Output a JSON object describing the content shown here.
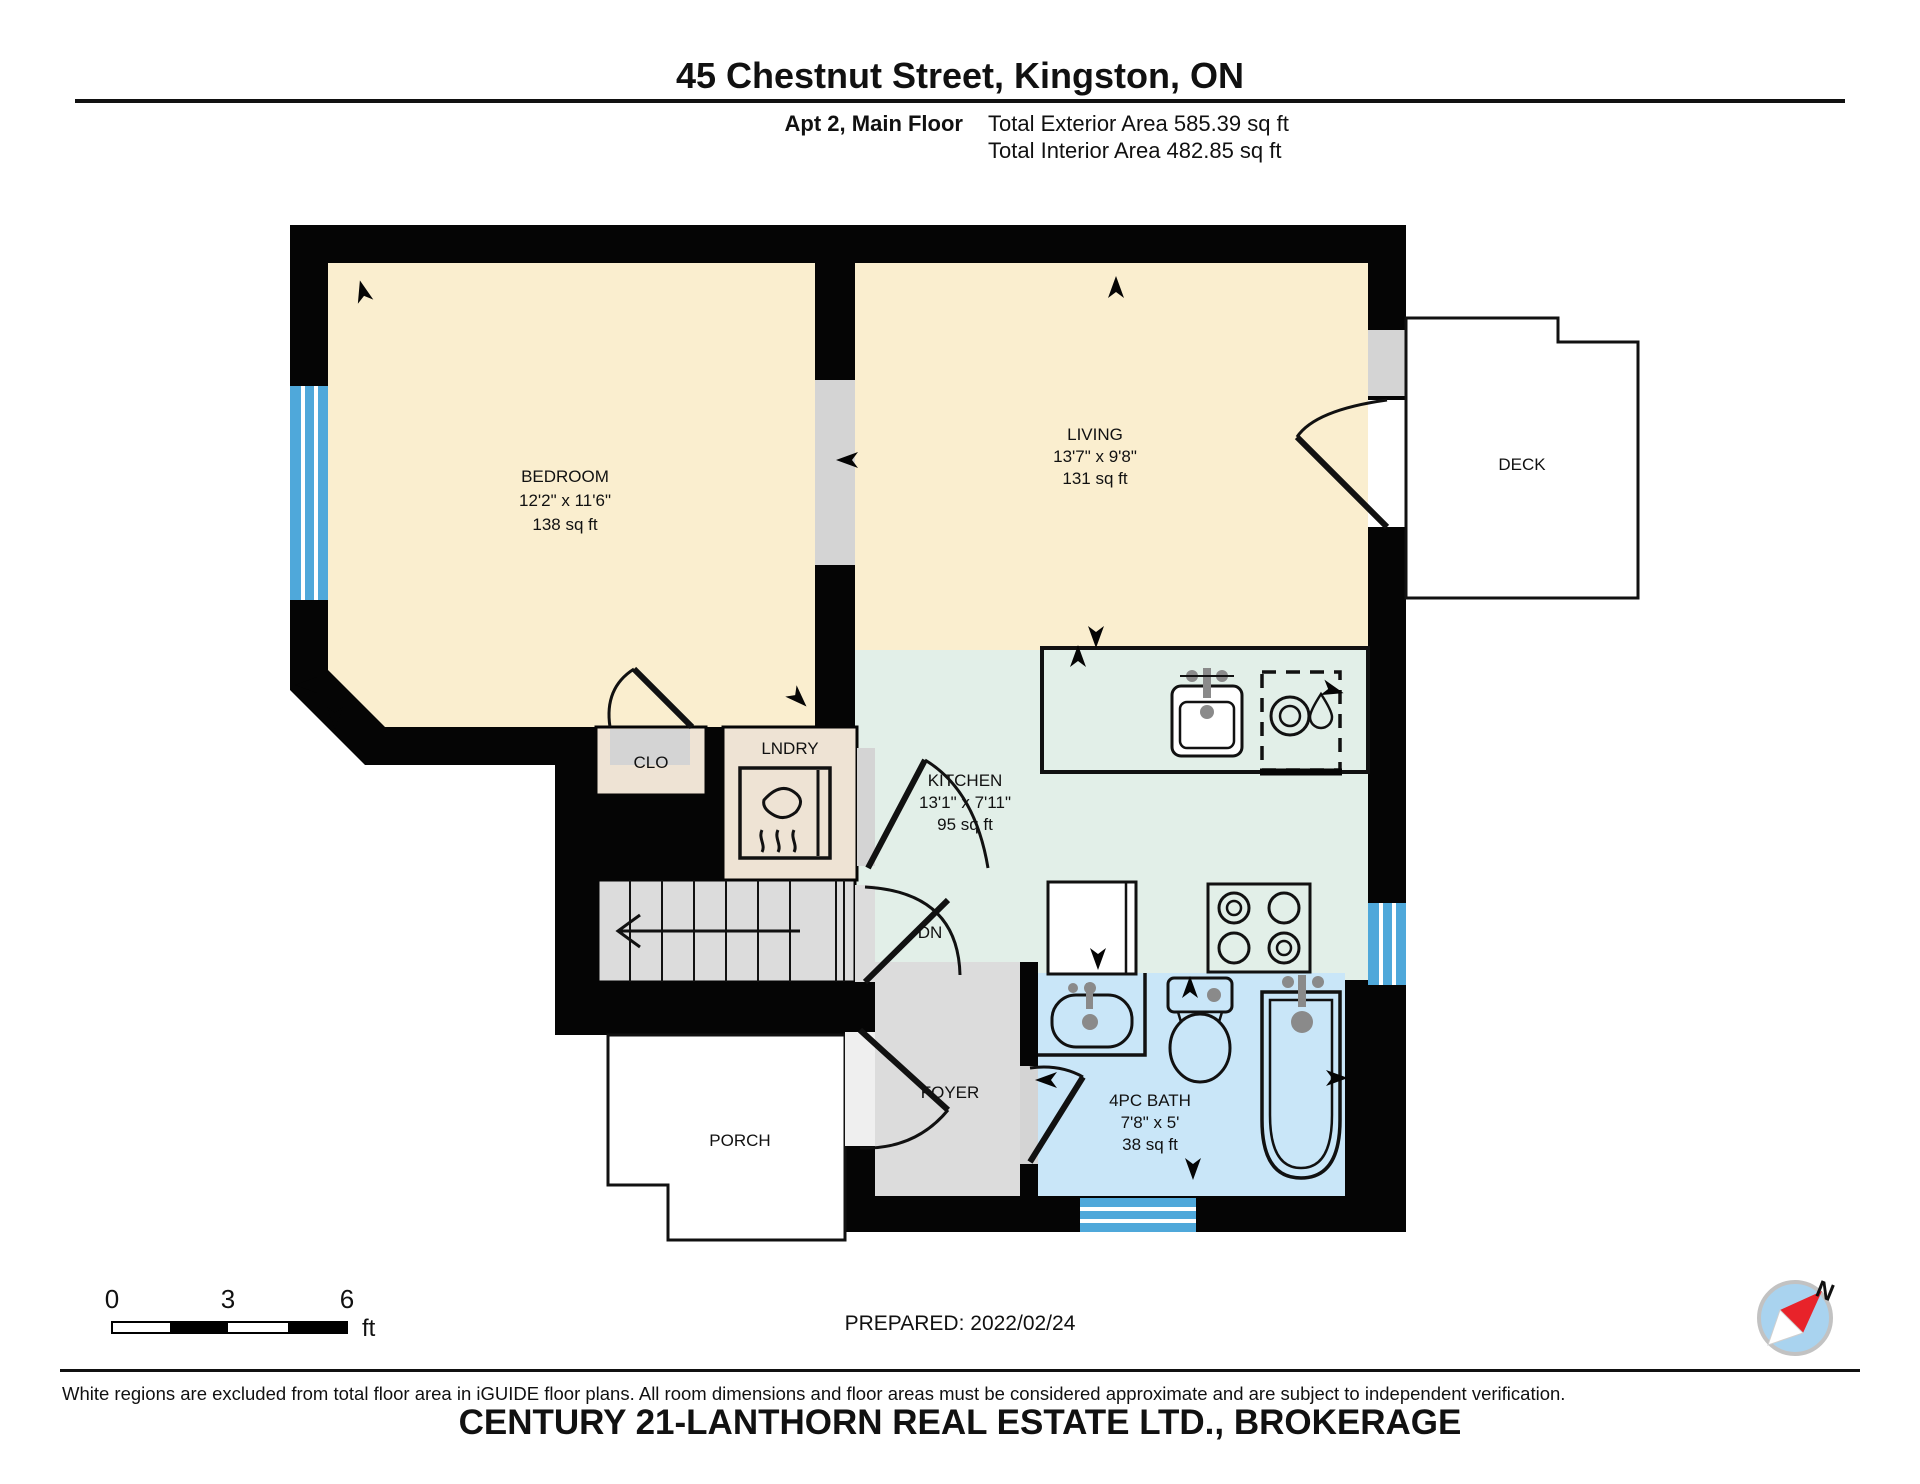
{
  "header": {
    "title": "45 Chestnut Street, Kingston, ON",
    "unit_label": "Apt 2, Main Floor",
    "exterior_area": "Total Exterior Area 585.39 sq ft",
    "interior_area": "Total Interior Area 482.85 sq ft"
  },
  "rooms": {
    "bedroom": {
      "name": "BEDROOM",
      "dimensions": "12'2\" x 11'6\"",
      "area": "138 sq ft"
    },
    "living": {
      "name": "LIVING",
      "dimensions": "13'7\" x 9'8\"",
      "area": "131 sq ft"
    },
    "kitchen": {
      "name": "KITCHEN",
      "dimensions": "13'1\" x 7'11\"",
      "area": "95 sq ft"
    },
    "bath": {
      "name": "4PC BATH",
      "dimensions": "7'8\" x 5'",
      "area": "38 sq ft"
    },
    "deck": {
      "name": "DECK"
    },
    "closet": {
      "name": "CLO"
    },
    "laundry": {
      "name": "LNDRY"
    },
    "stairs": {
      "name": "DN"
    },
    "foyer": {
      "name": "FOYER"
    },
    "porch": {
      "name": "PORCH"
    }
  },
  "scale_bar": {
    "tick0": "0",
    "tick3": "3",
    "tick6": "6",
    "unit": "ft"
  },
  "footer": {
    "prepared": "PREPARED: 2022/02/24",
    "compass_label": "N",
    "disclaimer": "White regions are excluded from total floor area in iGUIDE floor plans. All room dimensions and floor areas must be considered approximate and are subject to independent verification.",
    "watermark": "CENTURY 21-LANTHORN REAL ESTATE LTD., BROKERAGE"
  },
  "icons": [
    "compass-icon",
    "kitchen-sink-icon",
    "dishwasher-icon",
    "stove-icon",
    "fridge-icon",
    "dryer-icon",
    "bath-sink-icon",
    "toilet-icon",
    "bathtub-icon",
    "stairs-arrow-icon",
    "direction-arrow-icon"
  ],
  "colors": {
    "wall": "#050505",
    "bedroom_living_fill": "#FAEECF",
    "kitchen_fill": "#E2EFE8",
    "bath_fill": "#C9E6F8",
    "closet_laundry_fill": "#EEE3D4",
    "foyer_stairs_fill": "#DCDCDC",
    "opening_gray": "#D4D4D4",
    "window_blue": "#4FA8DA",
    "compass_red": "#E8232A",
    "compass_blue": "#A9D3EF",
    "watermark_gray": "#D6D6D6"
  }
}
